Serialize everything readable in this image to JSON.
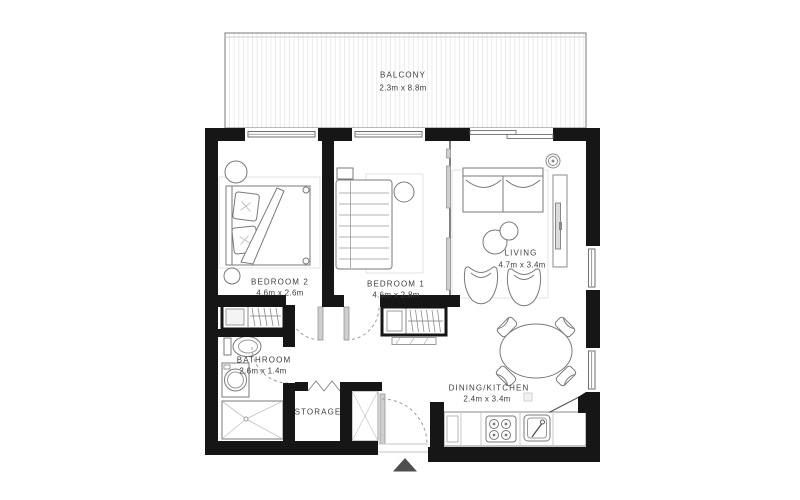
{
  "rooms": {
    "balcony": {
      "name": "BALCONY",
      "dims": "2.3m x 8.8m"
    },
    "bedroom2": {
      "name": "BEDROOM 2",
      "dims": "4.6m x 2.6m"
    },
    "bedroom1": {
      "name": "BEDROOM 1",
      "dims": "4.6m x 2.8m"
    },
    "living": {
      "name": "LIVING",
      "dims": "4.7m x 3.4m"
    },
    "bathroom": {
      "name": "BATHROOM",
      "dims": "2.6m x 1.4m"
    },
    "storage": {
      "name": "STORAGE"
    },
    "dining_kitchen": {
      "name": "DINING/KITCHEN",
      "dims": "2.4m x 3.4m"
    }
  },
  "icons": {
    "entrance_marker": "triangle-up",
    "ceiling_light": "concentric-circles"
  },
  "colors": {
    "wall": "#161616",
    "furniture_line": "#7a7a7a",
    "door_arc": "#9a9a9a",
    "text": "#3e3e3e",
    "entrance_arrow": "#4f4f4f",
    "balcony_stripe": "#e9e9e9"
  }
}
